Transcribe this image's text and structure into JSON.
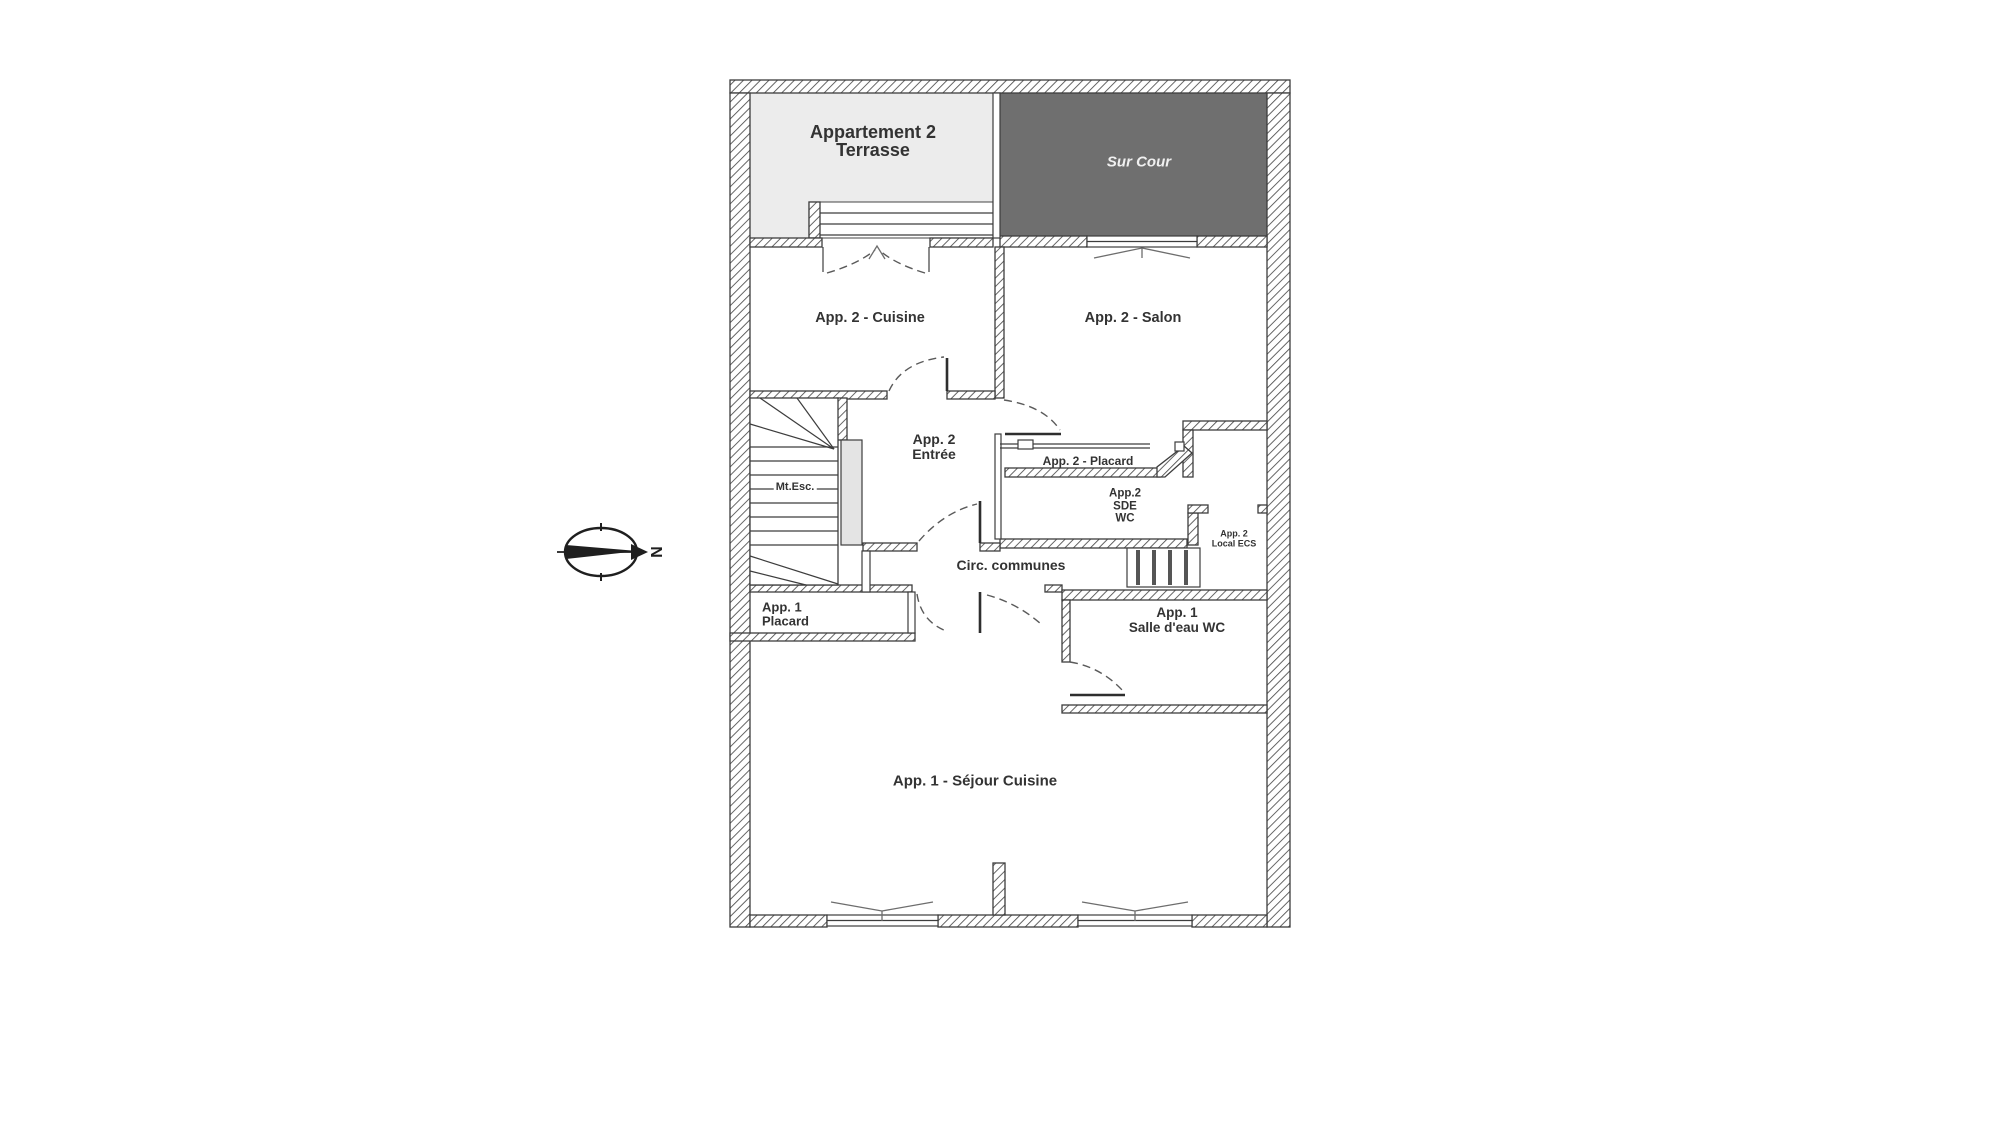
{
  "page": {
    "background": "#ffffff"
  },
  "colors": {
    "wall_line": "#3d3d3d",
    "hatch_line": "#4a4a4a",
    "terrace_fill": "#ececec",
    "courtyard_fill": "#6f6f6f",
    "newel_fill": "#e4e4e4",
    "label_text": "#333333",
    "courtyard_text": "#f0f0f0"
  },
  "compass": {
    "north_label": "N"
  },
  "plan": {
    "labels": {
      "terrasse_line1": "Appartement 2",
      "terrasse_line2": "Terrasse",
      "sur_cour": "Sur Cour",
      "cuisine": "App. 2 - Cuisine",
      "salon": "App. 2 - Salon",
      "entree_line1": "App. 2",
      "entree_line2": "Entrée",
      "mt_esc": "Mt.Esc.",
      "placard_app2": "App. 2 - Placard",
      "sde_line1": "App.2",
      "sde_line2": "SDE",
      "sde_line3": "WC",
      "local_ecs_line1": "App. 2",
      "local_ecs_line2": "Local ECS",
      "circ_communes": "Circ. communes",
      "placard_app1_line1": "App. 1",
      "placard_app1_line2": "Placard",
      "salle_eau_line1": "App. 1",
      "salle_eau_line2": "Salle d'eau WC",
      "sejour": "App. 1 - Séjour Cuisine"
    }
  }
}
